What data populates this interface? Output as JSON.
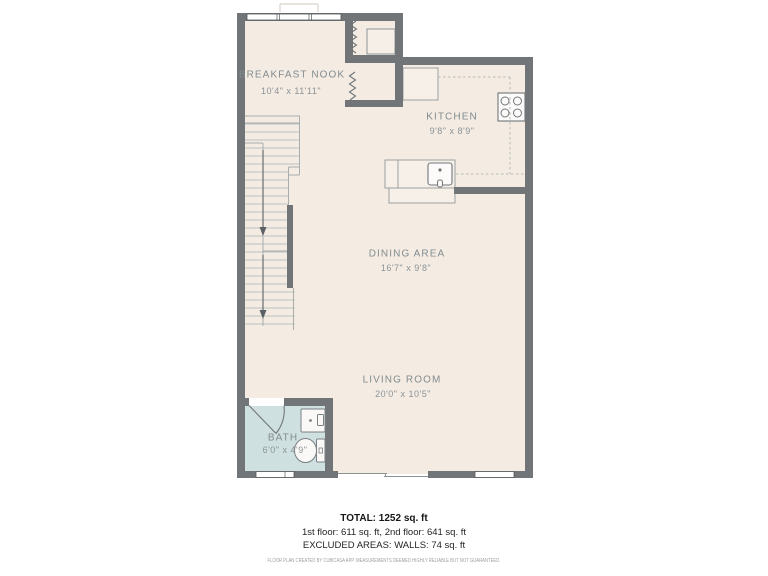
{
  "plan": {
    "rooms": [
      {
        "id": "breakfast_nook",
        "name": "BREAKFAST NOOK",
        "dims": "10'4\" x 11'11\""
      },
      {
        "id": "kitchen",
        "name": "KITCHEN",
        "dims": "9'8\" x 8'9\""
      },
      {
        "id": "dining_area",
        "name": "DINING AREA",
        "dims": "16'7\" x 9'8\""
      },
      {
        "id": "living_room",
        "name": "LIVING ROOM",
        "dims": "20'0\" x 10'5\""
      },
      {
        "id": "bath",
        "name": "BATH",
        "dims": "6'0\" x 4'9\""
      }
    ],
    "colors": {
      "wall": "#717578",
      "floor": "#f4ebe3",
      "bath_floor": "#cfe0e1",
      "label": "#828c8f"
    }
  },
  "summary": {
    "total": "TOTAL: 1252 sq. ft",
    "floors": "1st floor: 611 sq. ft, 2nd floor: 641 sq. ft",
    "excluded": "EXCLUDED AREAS: WALLS: 74 sq. ft"
  },
  "footer": {
    "disclaimer": "FLOOR PLAN CREATED BY CUBICASA APP. MEASUREMENTS DEEMED HIGHLY RELIABLE BUT NOT GUARANTEED."
  }
}
